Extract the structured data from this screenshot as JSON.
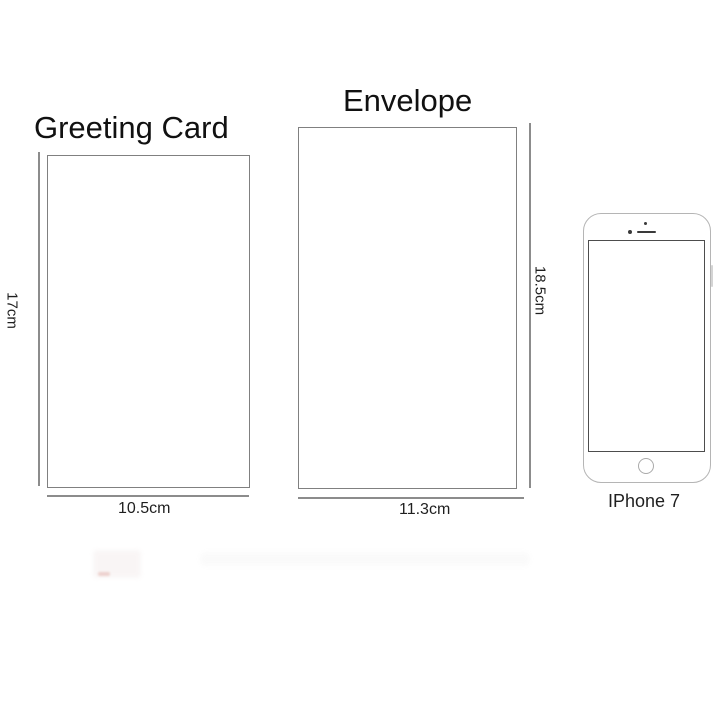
{
  "diagram": {
    "greeting_card": {
      "title": "Greeting Card",
      "height_label": "17cm",
      "width_label": "10.5cm"
    },
    "envelope": {
      "title": "Envelope",
      "height_label": "18.5cm",
      "width_label": "11.3cm"
    },
    "iphone": {
      "label": "IPhone 7"
    }
  },
  "colors": {
    "background": "#ffffff",
    "text": "#111111",
    "rectangle_border": "#808080",
    "dimension_line": "#8c8c8c",
    "phone_outline": "#b5b5b5",
    "phone_screen_border": "#4d4d4d",
    "phone_detail": "#3a3a3a",
    "home_button_ring": "#aaaaaa"
  }
}
